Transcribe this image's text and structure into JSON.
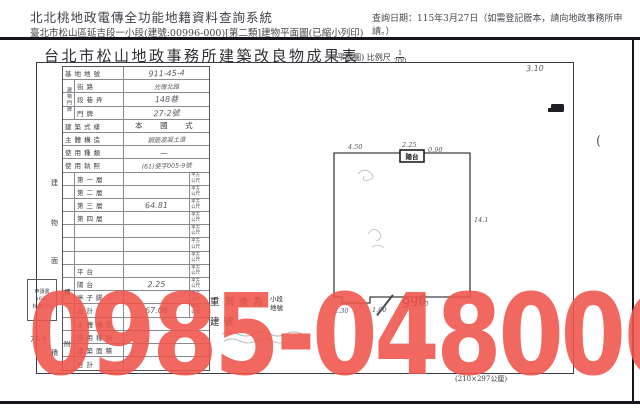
{
  "header": {
    "system_title": "北北桃地政電傳全功能地籍資料查詢系統",
    "query_date": "查詢日期：115年3月27日（如需登記謄本，請向地政事務所申請。）",
    "doc_line": "臺北市松山區延吉段一小段(建號:00996-000)[第二類]建物平面圖(已縮小列印)"
  },
  "form": {
    "title": "台北市松山地政事務所建築改良物成果表",
    "scale_label": "(平面圖) 比例尺",
    "scale_numerator": "1",
    "scale_denominator": "200",
    "paper_size": "(210×297公厘)"
  },
  "table": {
    "unit_line1": "平方",
    "unit_line2": "公尺",
    "vertical_label_address": "建物門牌",
    "area_char_1": "建",
    "area_char_2": "物",
    "area_char_3": "面",
    "area_char_4": "積",
    "floor_group_label": "樓",
    "annex_group_label": "附",
    "rows": [
      {
        "label": "基地地號",
        "value": "911-45-4"
      },
      {
        "label": "街路",
        "value": "光復北路"
      },
      {
        "label": "段巷弄",
        "value": "148巷"
      },
      {
        "label": "門牌",
        "value": "27-2號"
      },
      {
        "label": "建築式樣",
        "value": "本　國　式"
      },
      {
        "label": "主體構造",
        "value": "鋼筋混凝土造"
      },
      {
        "label": "使用種類",
        "value": "—"
      },
      {
        "label": "使用執照",
        "value": "(61)使字005-9號"
      },
      {
        "label": "第一層",
        "value": ""
      },
      {
        "label": "第二層",
        "value": ""
      },
      {
        "label": "第三層",
        "value": "64.81"
      },
      {
        "label": "第四層",
        "value": ""
      },
      {
        "label": "",
        "value": ""
      },
      {
        "label": "",
        "value": ""
      },
      {
        "label": "",
        "value": ""
      },
      {
        "label": "平台",
        "value": ""
      },
      {
        "label": "陽台",
        "value": "2.25"
      },
      {
        "label": "亭子脚",
        "value": ""
      },
      {
        "label": "合計",
        "value": "67.06"
      },
      {
        "label": "主體構造",
        "value": ""
      },
      {
        "label": "使用種類",
        "value": ""
      },
      {
        "label": "建築面積",
        "value": ""
      },
      {
        "label": "合計",
        "value": ""
      }
    ]
  },
  "stamps": {
    "application_box_line1": "申請書",
    "application_box_line2": "(61)",
    "application_box_line3": "松地(二)",
    "hand_note": "74.4",
    "remeasure_line": "重測後為",
    "remeasure_small1": "小段",
    "remeasure_small2": "地號",
    "building_no_label": "建號",
    "hand_building_no": "996",
    "margin_note": "3.10",
    "margin_paren": "("
  },
  "plan": {
    "balcony_label": "陽台",
    "dim_top": "4.50",
    "dim_top_balcony": "2.25",
    "dim_right_top": "0.90",
    "dim_right_mid": "14.1",
    "dim_bottom_left": "2.30",
    "dim_bottom_mid": "1.00",
    "dim_bottom_right": "5.70"
  },
  "watermark": {
    "text": "0985-048006",
    "color": "#ef5449"
  }
}
